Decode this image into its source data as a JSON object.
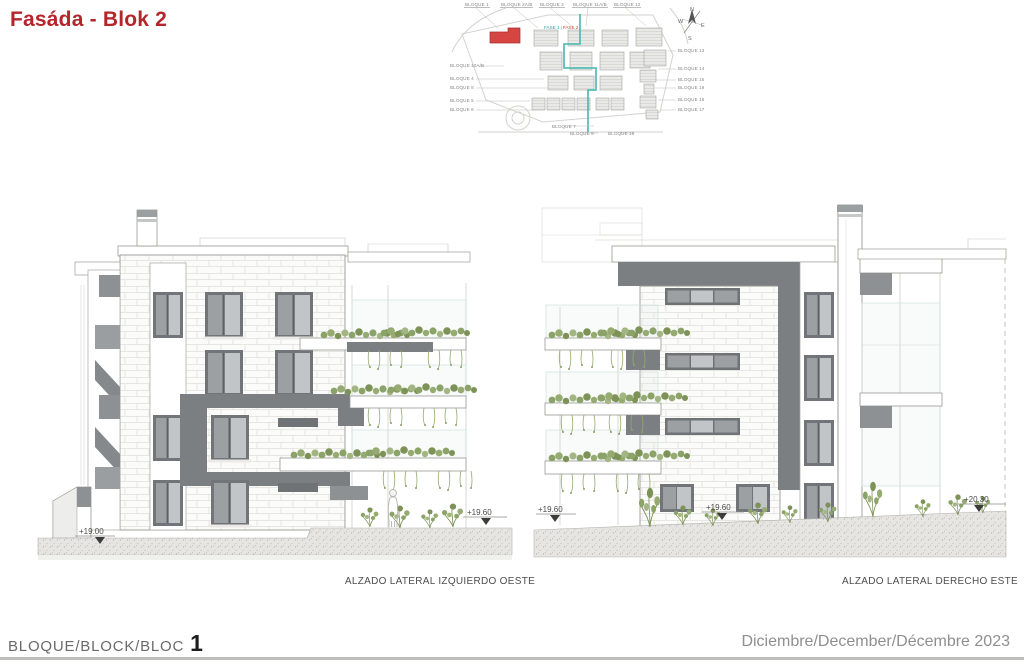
{
  "title": "Fasáda - Blok 2",
  "siteplan": {
    "top_labels": [
      "BLOQUE 1",
      "BLOQUE 2A/B",
      "BLOQUE 3",
      "BLOQUE 11A/B",
      "BLOQUE 12"
    ],
    "fase_labels": {
      "fase1": "FASE 1",
      "divider": "|",
      "fase2": "FASE 2"
    },
    "left_labels": [
      "BLOQUE 10A/B",
      "BLOQUE 4",
      "BLOQUE 8",
      "BLOQUE 5",
      "BLOQUE 6"
    ],
    "right_labels": [
      "BLOQUE 13",
      "BLOQUE 14",
      "BLOQUE 15",
      "BLOQUE 19",
      "BLOQUE 16",
      "BLOQUE 17"
    ],
    "bottom_labels": [
      "BLOQUE 7",
      "BLOQUE 9",
      "BLOQUE 18"
    ],
    "compass": {
      "n": "N",
      "e": "E",
      "s": "S",
      "w": "W"
    }
  },
  "elevations": {
    "left": {
      "caption": "ALZADO LATERAL IZQUIERDO OESTE",
      "level_base": "+19.00",
      "level_garden": "+19.60"
    },
    "right": {
      "caption": "ALZADO LATERAL DERECHO ESTE",
      "level_left": "+19.60",
      "level_mid": "+19.60",
      "level_right": "+20.30"
    }
  },
  "footer": {
    "block_label": "BLOQUE/BLOCK/BLOC",
    "block_number": "1",
    "date": "Diciembre/December/Décembre 2023"
  },
  "colors": {
    "accent_red": "#b3262c",
    "plan_highlight": "#d64541",
    "plan_route": "#49b8b0",
    "band_gray": "#7b7f82"
  }
}
